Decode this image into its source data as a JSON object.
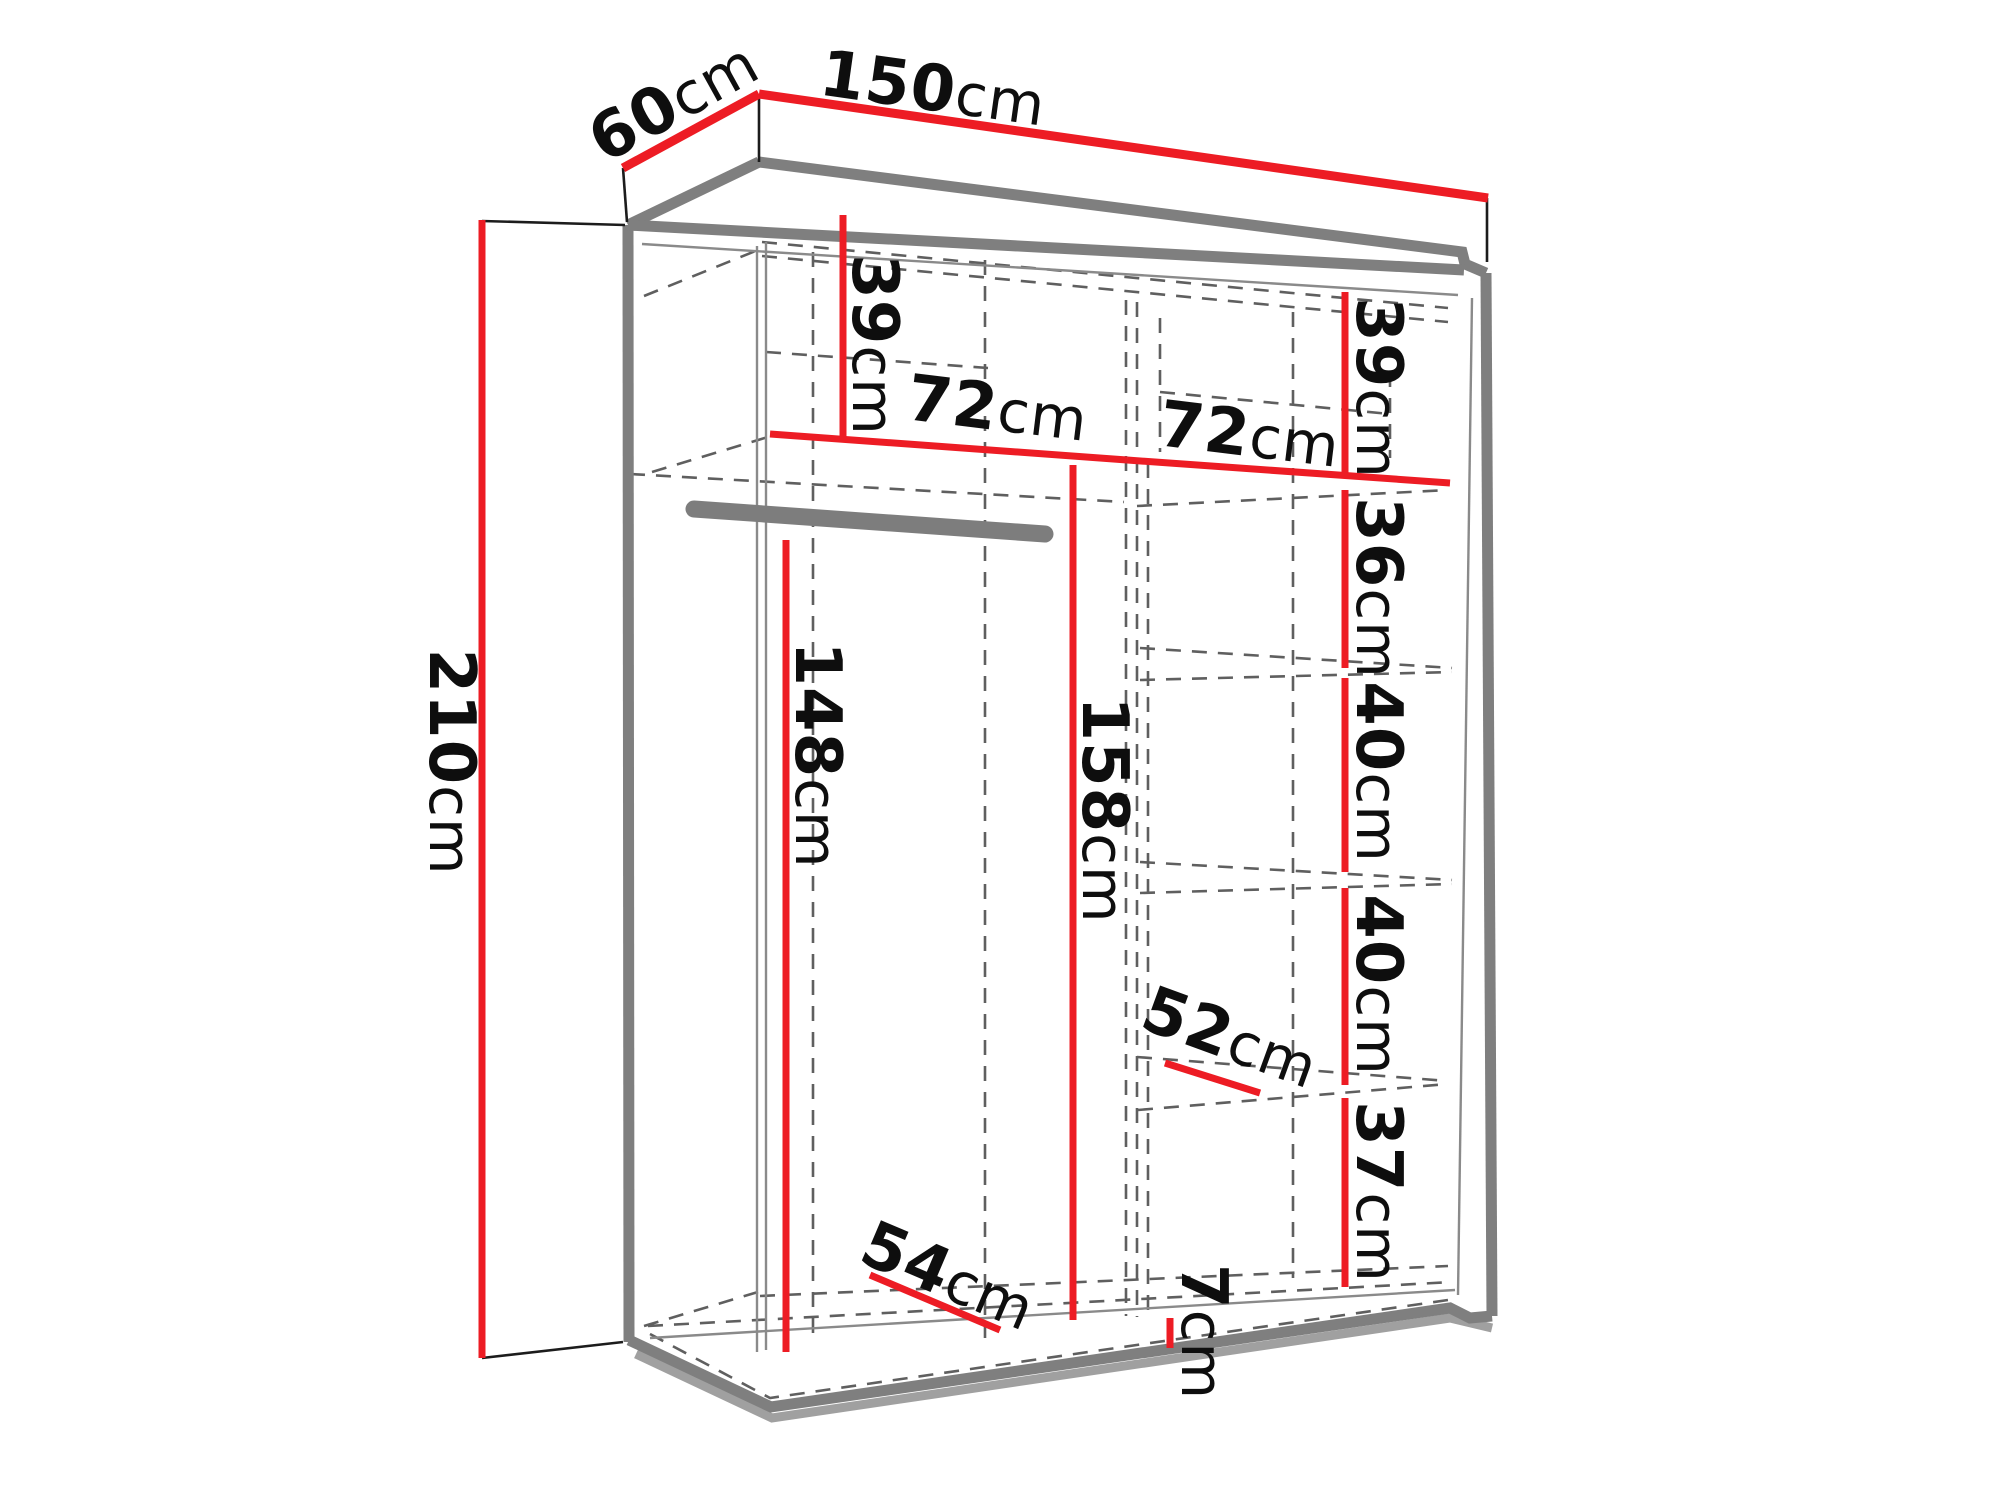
{
  "diagram": {
    "type": "wardrobe-dimension-drawing",
    "colors": {
      "dimension_line": "#ed1c24",
      "carcass_outline": "#7f7f7f",
      "hidden_edges": "#5f5f5f",
      "text": "#0e0e0e",
      "background": "#ffffff"
    },
    "dimensions": {
      "width": {
        "value": "150",
        "unit": "cm"
      },
      "depth": {
        "value": "60",
        "unit": "cm"
      },
      "height": {
        "value": "210",
        "unit": "cm"
      },
      "left_top_cubby": {
        "value": "39",
        "unit": "cm"
      },
      "left_shelf_width": {
        "value": "72",
        "unit": "cm"
      },
      "hanging_space": {
        "value": "148",
        "unit": "cm"
      },
      "left_inner_height": {
        "value": "158",
        "unit": "cm"
      },
      "floor_depth": {
        "value": "54",
        "unit": "cm"
      },
      "right_top_cubby": {
        "value": "39",
        "unit": "cm"
      },
      "right_shelf_width": {
        "value": "72",
        "unit": "cm"
      },
      "gap_below_shelf1": {
        "value": "36",
        "unit": "cm"
      },
      "gap_shelf2": {
        "value": "40",
        "unit": "cm"
      },
      "gap_shelf3": {
        "value": "40",
        "unit": "cm"
      },
      "shelf_depth": {
        "value": "52",
        "unit": "cm"
      },
      "gap_bottom": {
        "value": "37",
        "unit": "cm"
      },
      "plinth_height": {
        "value": "7",
        "unit": "cm"
      }
    }
  }
}
